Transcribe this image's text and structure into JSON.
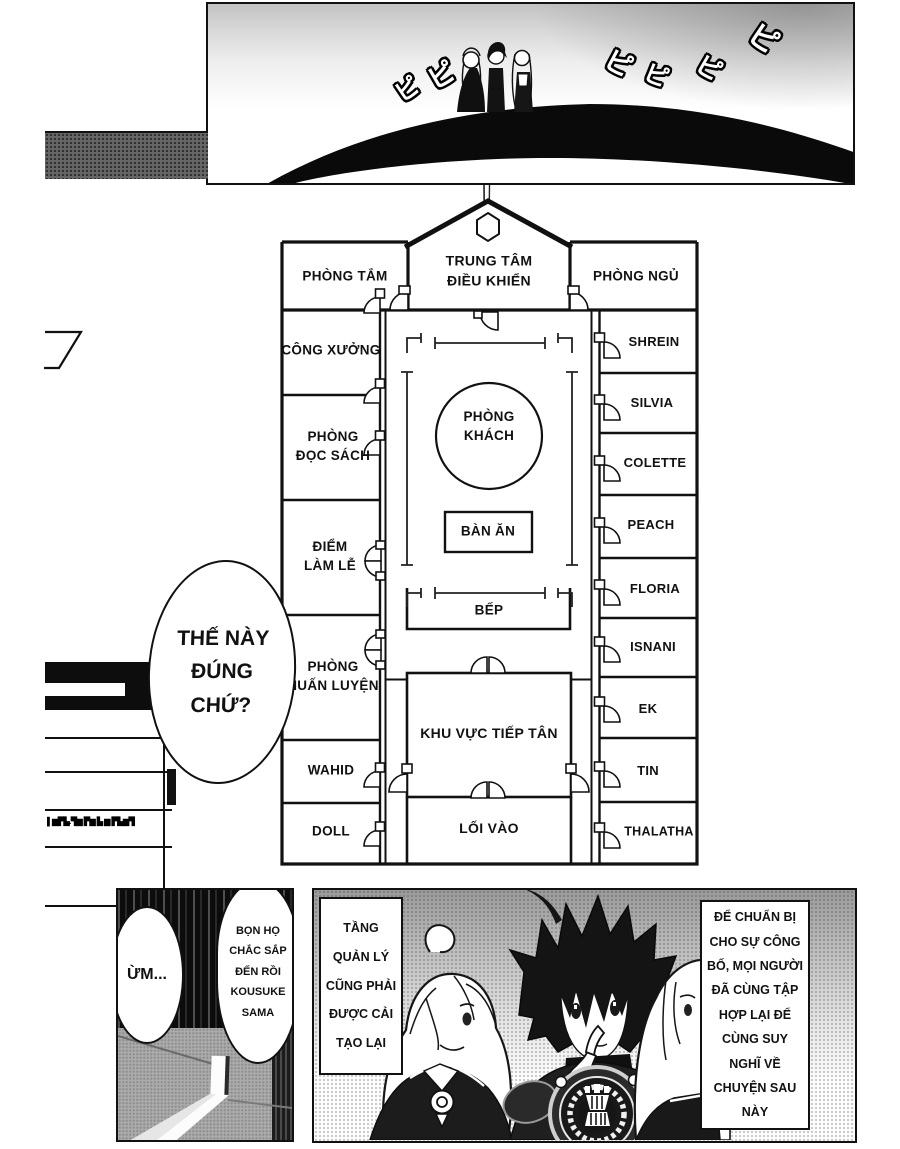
{
  "sfx": {
    "beep": "ピ"
  },
  "floorplan": {
    "control_room": "TRUNG TÂM\nĐIỀU KHIỂN",
    "left_rooms": [
      "PHÒNG TẮM",
      "CÔNG XƯỞNG",
      "PHÒNG\nĐỌC SÁCH",
      "ĐIỂM\nLÀM LỄ",
      "PHÒNG\nHUẤN LUYỆN",
      "WAHID",
      "DOLL"
    ],
    "right_rooms": [
      "PHÒNG NGỦ",
      "SHREIN",
      "SILVIA",
      "COLETTE",
      "PEACH",
      "FLORIA",
      "ISNANI",
      "EK",
      "TIN",
      "THALATHA"
    ],
    "center": {
      "living_room": "PHÒNG\nKHÁCH",
      "dining_table": "BÀN ĂN",
      "kitchen": "BẾP",
      "reception": "KHU VỰC TIẾP TÂN",
      "entrance": "LỐI VÀO"
    }
  },
  "speech": {
    "confirm": "THẾ NÀY\nĐÚNG\nCHỨ?",
    "um": "ỪM...",
    "arrival": "BỌN HỌ\nCHẮC SẮP\nĐẾN RỒI\nKOUSUKE\nSAMA"
  },
  "captions": {
    "management": "TẦNG\nQUẢN LÝ\nCŨNG PHẢI\nĐƯỢC CẢI\nTẠO LẠI",
    "announcement": "ĐỂ CHUẨN BỊ\nCHO SỰ CÔNG\nBỐ, MỌI NGƯỜI\nĐÃ CÙNG TẬP\nHỢP LẠI ĐỂ\nCÙNG SUY\nNGHĨ VỀ\nCHUYỆN SAU\nNÀY",
    "illegible": "▌▆▛▙.▜▆ ▛▆ ▙ ▆ ▛▙▆▜"
  },
  "colors": {
    "ink": "#111111",
    "paper": "#ffffff",
    "panel_gray": "#a8a8a8"
  }
}
